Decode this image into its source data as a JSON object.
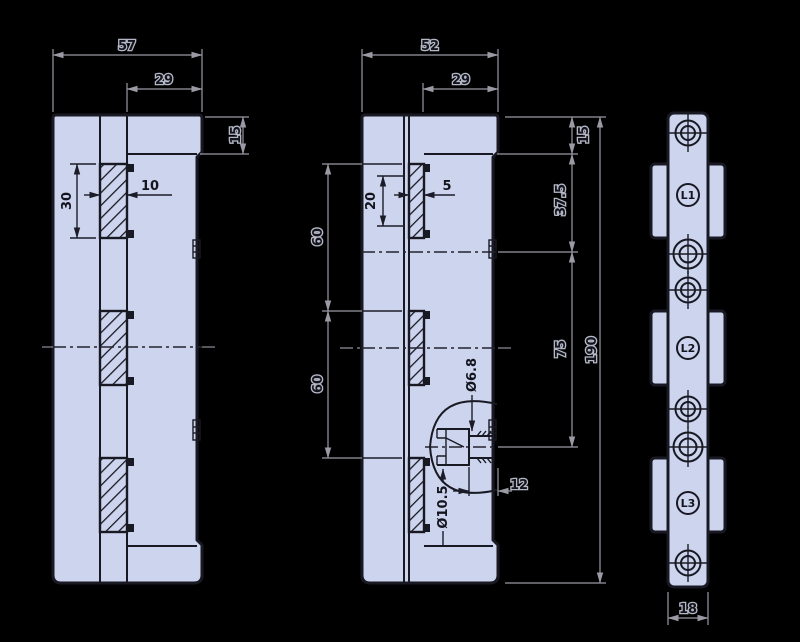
{
  "drawing": {
    "type": "technical-orthographic-drawing",
    "colors": {
      "background": "#000000",
      "part_fill": "#cdd5ee",
      "outline": "#191923",
      "dimension": "#9a9aa4"
    },
    "views": {
      "front": {
        "name": "front-view",
        "dims": {
          "overall_width": "57",
          "flange_width": "29",
          "top_step_height": "15",
          "slot_length": "30",
          "slot_width": "10"
        }
      },
      "section": {
        "name": "section-view",
        "dims": {
          "overall_width": "52",
          "flange_width": "29",
          "top_step_height": "15",
          "slot_opening_length": "20",
          "slot_opening_width": "5",
          "slot_pitch_1": "60",
          "slot_pitch_2": "60",
          "step_to_first_hole": "37.5",
          "hole_pitch": "75",
          "overall_height": "190",
          "through_hole_dia": "Ø6.8",
          "counterbore_dia": "Ø10.5",
          "counterbore_to_face": "12"
        }
      },
      "side": {
        "name": "side-view",
        "dims": {
          "thickness": "18"
        },
        "labels": [
          {
            "text": "L1"
          },
          {
            "text": "L2"
          },
          {
            "text": "L3"
          }
        ]
      }
    }
  }
}
